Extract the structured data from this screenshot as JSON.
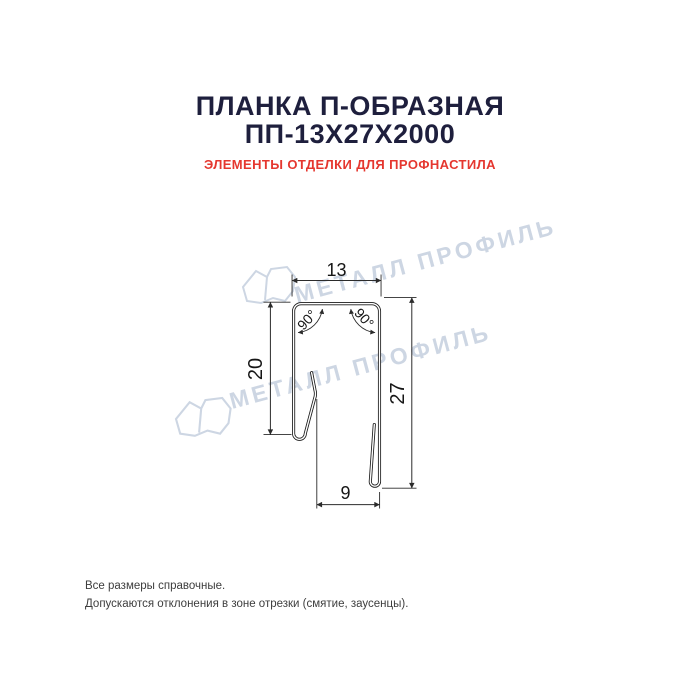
{
  "header": {
    "title_line1": "ПЛАНКА П-ОБРАЗНАЯ",
    "title_line2": "ПП-13Х27Х2000",
    "subtitle": "ЭЛЕМЕНТЫ ОТДЕЛКИ ДЛЯ ПРОФНАСТИЛА"
  },
  "drawing": {
    "type": "profile-cross-section",
    "dimensions": {
      "top_width": "13",
      "left_height": "20",
      "right_height": "27",
      "bottom_opening": "9",
      "angle_left": "90°",
      "angle_right": "90°"
    },
    "watermark": {
      "text": "МЕТАЛЛ ПРОФИЛЬ",
      "logo": "metall-profil-logo"
    }
  },
  "footer": {
    "line1": "Все размеры справочные.",
    "line2": "Допускаются отклонения в зоне отрезки (смятие, заусенцы)."
  },
  "colors": {
    "title": "#1e1f3d",
    "subtitle": "#e5372f",
    "watermark": "#cdd6e3",
    "line": "#1a1a1a",
    "background": "#ffffff"
  }
}
